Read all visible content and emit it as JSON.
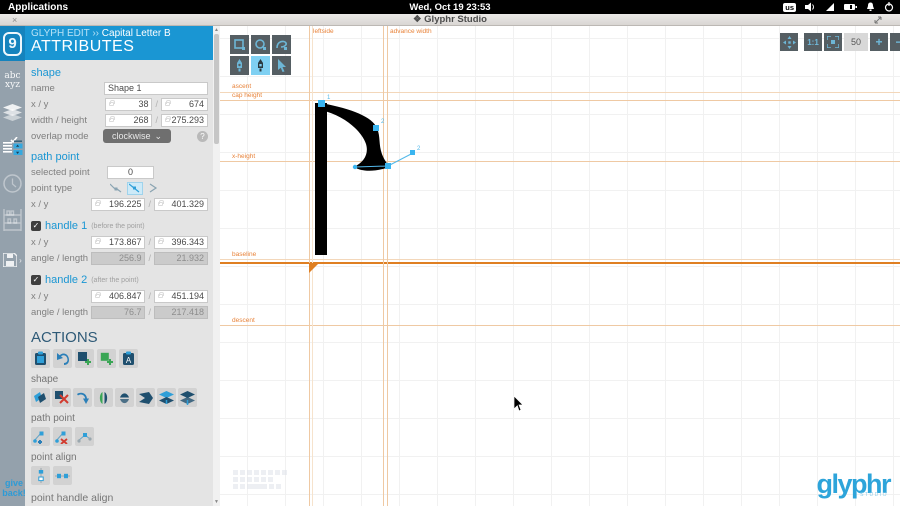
{
  "system_bar": {
    "menu": "Applications",
    "clock": "Wed, Oct 19 23:53",
    "keyboard_layout": "us"
  },
  "window": {
    "title": "❖ Glyphr Studio",
    "close": "×"
  },
  "sidebar": {
    "logo_glyph": "9",
    "glyphs_item": "abc\nxyz",
    "give_back": "give back!",
    "icons": [
      "glyphr-logo",
      "glyph-list",
      "layers",
      "attributes-panel",
      "history-clock",
      "shelf",
      "save-disk"
    ]
  },
  "panel": {
    "header": {
      "breadcrumb": "GLYPH EDIT",
      "separator": "››",
      "glyph_name": "Capital Letter B",
      "title": "ATTRIBUTES"
    },
    "shape": {
      "heading": "shape",
      "name_label": "name",
      "name_value": "Shape 1",
      "xy_label": "x / y",
      "x": "38",
      "y": "674",
      "wh_label": "width / height",
      "width": "268",
      "height": "275.293",
      "overlap_label": "overlap mode",
      "overlap_value": "clockwise",
      "overlap_caret": "⌄",
      "help": "?",
      "slash": "/"
    },
    "path_point": {
      "heading": "path point",
      "selected_label": "selected point",
      "selected_value": "0",
      "type_label": "point type",
      "xy_label": "x / y",
      "x": "196.225",
      "y": "401.329"
    },
    "handle1": {
      "check": "✓",
      "heading": "handle 1",
      "hint": "(before the point)",
      "xy_label": "x / y",
      "x": "173.867",
      "y": "396.343",
      "al_label": "angle / length",
      "angle": "256.9",
      "length": "21.932"
    },
    "handle2": {
      "check": "✓",
      "heading": "handle 2",
      "hint": "(after the point)",
      "xy_label": "x / y",
      "x": "406.847",
      "y": "451.194",
      "al_label": "angle / length",
      "angle": "76.7",
      "length": "217.418"
    },
    "actions": {
      "heading": "ACTIONS",
      "glyph_icons": [
        "paste-shape",
        "undo",
        "add-shape",
        "add-component-instance",
        "paste-glyph"
      ],
      "shape_label": "shape",
      "shape_icons": [
        "copy-shape",
        "delete-shape",
        "rotate-shape",
        "flip-horizontal",
        "flip-vertical",
        "reverse-winding",
        "move-shape-up",
        "move-shape-down"
      ],
      "path_point_label": "path point",
      "path_point_icons": [
        "insert-path-point",
        "delete-path-point",
        "reset-point-handles"
      ],
      "point_align_label": "point align",
      "point_align_icons": [
        "align-points-x",
        "align-points-y"
      ],
      "point_handle_align_label": "point handle align"
    }
  },
  "canvas": {
    "tools": {
      "row1": [
        "new-rectangle",
        "new-oval",
        "new-path"
      ],
      "row2": [
        "path-edit",
        "path-add-point",
        "shape-resize"
      ],
      "active": "path-add-point"
    },
    "view": {
      "pan": "pan",
      "one_to_one": "1:1",
      "zoom_fit": "zoom-fit",
      "zoom_value": "50",
      "zoom_in": "+",
      "zoom_out": "−"
    },
    "guides": {
      "ascent": "ascent",
      "cap_height": "cap height",
      "x_height": "x-height",
      "baseline": "baseline",
      "descent": "descent",
      "leftside": "leftside",
      "advance_width": "advance width"
    },
    "edit_points": {
      "selected_label": "1",
      "point2_label": "2",
      "handle2_label": "2"
    },
    "accent_orange": "#e8833a",
    "accent_blue": "#3ab5f0"
  },
  "brand": {
    "name": "glyphr",
    "sub": "STUDIO"
  }
}
